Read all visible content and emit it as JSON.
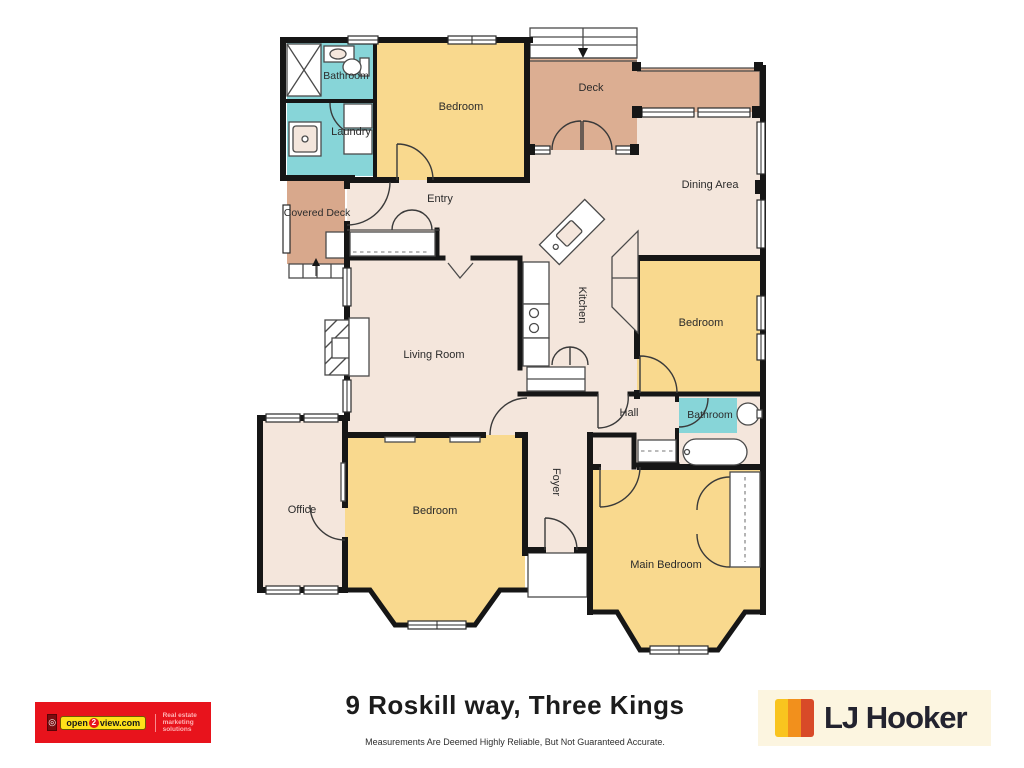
{
  "plan": {
    "rooms": {
      "bathroom_top": "Bathroom",
      "laundry": "Laundry",
      "bedroom_top": "Bedroom",
      "deck": "Deck",
      "dining_area": "Dining Area",
      "entry": "Entry",
      "covered_deck": "Covered Deck",
      "kitchen": "Kitchen",
      "living_room": "Living Room",
      "bedroom_right": "Bedroom",
      "bathroom_right": "Bathroom",
      "hall": "Hall",
      "foyer": "Foyer",
      "office": "Office",
      "bedroom_left": "Bedroom",
      "main_bedroom": "Main Bedroom"
    },
    "colors": {
      "floor": "#f4e6dc",
      "bedroom_fill": "#f9d98e",
      "wet_area_fill": "#87d5d8",
      "deck_fill": "#dcae92",
      "wall": "#161616"
    }
  },
  "footer": {
    "address": "9 Roskill way, Three Kings",
    "disclaimer": "Measurements Are Deemed Highly Reliable, But Not Guaranteed Accurate.",
    "open2view": {
      "brand_pre": "open",
      "brand_num": "2",
      "brand_post": "view.com",
      "tagline": "Real estate marketing solutions"
    },
    "ljhooker": {
      "name": "LJ Hooker"
    }
  }
}
